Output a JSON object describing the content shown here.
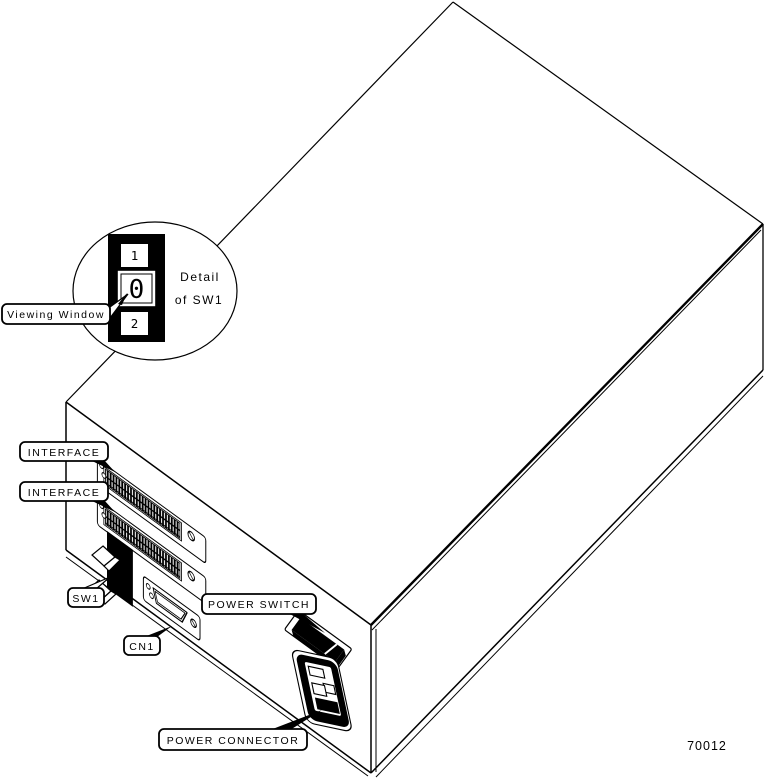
{
  "figure_number": "70012",
  "colors": {
    "ink": "#000000",
    "paper": "#ffffff"
  },
  "detail_callout": {
    "caption_line1": "Detail",
    "caption_line2": "of SW1",
    "switch_positions": {
      "top": "1",
      "middle": "0",
      "bottom": "2"
    },
    "selected_position": "0"
  },
  "labels": {
    "viewing_window": "Viewing Window",
    "interface_top": "INTERFACE",
    "interface_bottom": "INTERFACE",
    "sw1": "SW1",
    "cn1": "CN1",
    "power_switch": "POWER SWITCH",
    "power_connector": "POWER CONNECTOR"
  }
}
